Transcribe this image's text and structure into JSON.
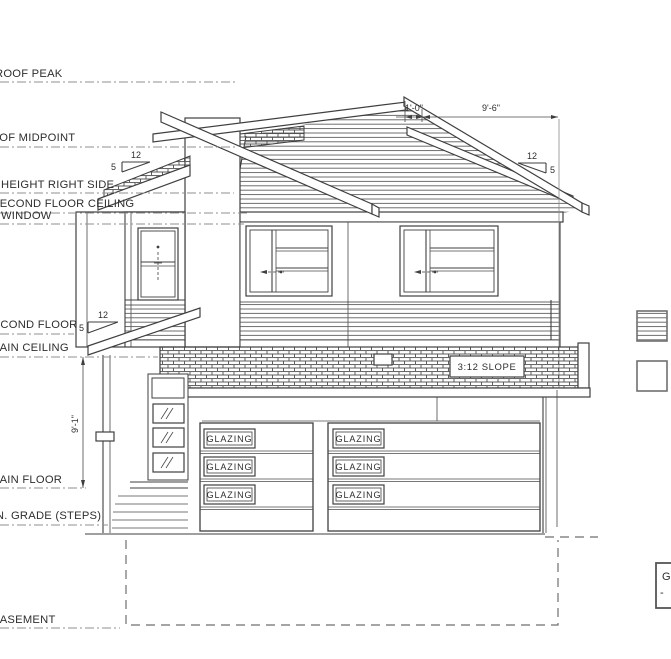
{
  "labels": {
    "roof_peak": "ROOF PEAK",
    "roof_midpoint": "ROOF MIDPOINT",
    "height_right_side": "HEIGHT RIGHT SIDE",
    "second_floor_ceiling": "SECOND FLOOR CEILING",
    "window": "WINDOW",
    "second_floor": "SECOND FLOOR",
    "main_ceiling": "MAIN CEILING",
    "main_floor": "MAIN FLOOR",
    "min_grade": "MIN. GRADE (STEPS)",
    "basement": "BASEMENT"
  },
  "dimensions": {
    "ridge_offset": "1'-0\"",
    "upper_roof_span": "9'-6\"",
    "main_floor_height": "9'-1\""
  },
  "slope": {
    "run": "12",
    "rise": "5"
  },
  "roof_band": {
    "label": "3:12 SLOPE"
  },
  "garage": {
    "glazing_label": "GLAZING"
  },
  "title_block": {
    "line1": "G",
    "line2": "-"
  }
}
